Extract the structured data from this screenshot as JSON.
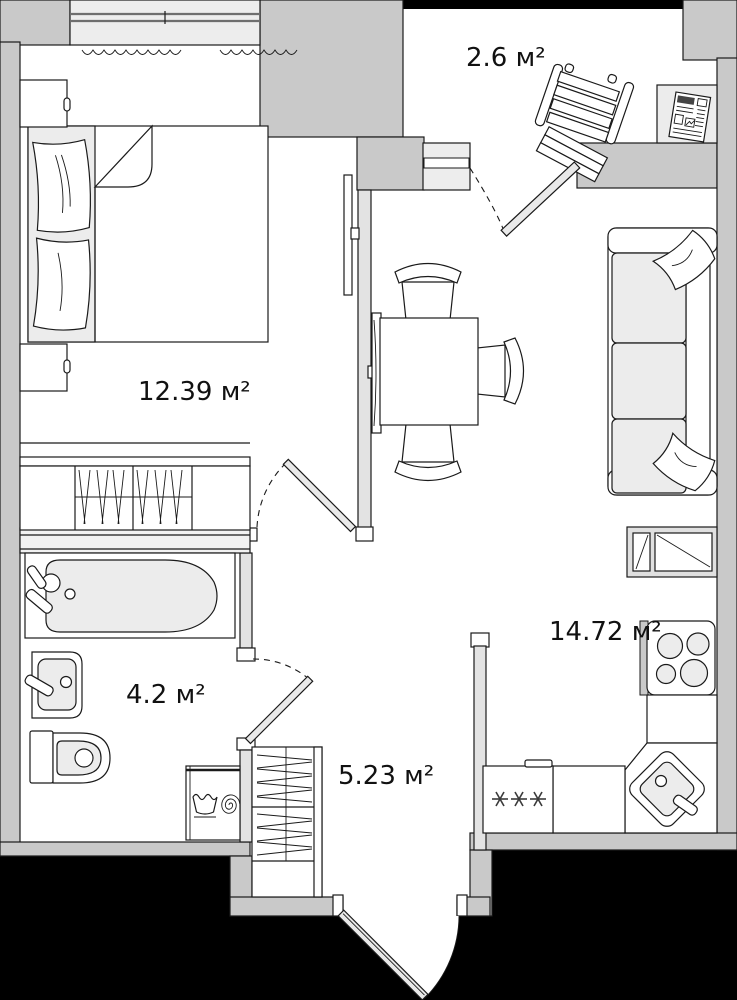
{
  "title": "Apartment floor plan",
  "rooms": {
    "bedroom": {
      "area": "12.39 м²"
    },
    "balcony": {
      "area": "2.6 м²"
    },
    "bathroom": {
      "area": "4.2 м²"
    },
    "hallway": {
      "area": "5.23 м²"
    },
    "kitchen_living": {
      "area": "14.72 м²"
    }
  },
  "colors": {
    "wall": "#c9c9c9",
    "partition": "#e3e3e3",
    "fixture_fill": "#ececec",
    "outside": "#000000",
    "line": "#1a1a1a",
    "floor": "#ffffff",
    "label_text": "#111111"
  },
  "icons": [
    "bed-icon",
    "pillow-icon",
    "nightstand-icon",
    "wardrobe-hangers-icon",
    "tv-icon",
    "dining-table-icon",
    "chair-icon",
    "sofa-icon",
    "deck-chair-icon",
    "newspaper-icon",
    "radiator-squiggle-icon",
    "bathtub-icon",
    "washbasin-icon",
    "toilet-icon",
    "washing-machine-icon",
    "stove-icon",
    "kitchen-sink-icon",
    "fridge-snowflakes-icon",
    "door-leaf-icon",
    "door-swing-arc-icon",
    "window-icon"
  ]
}
